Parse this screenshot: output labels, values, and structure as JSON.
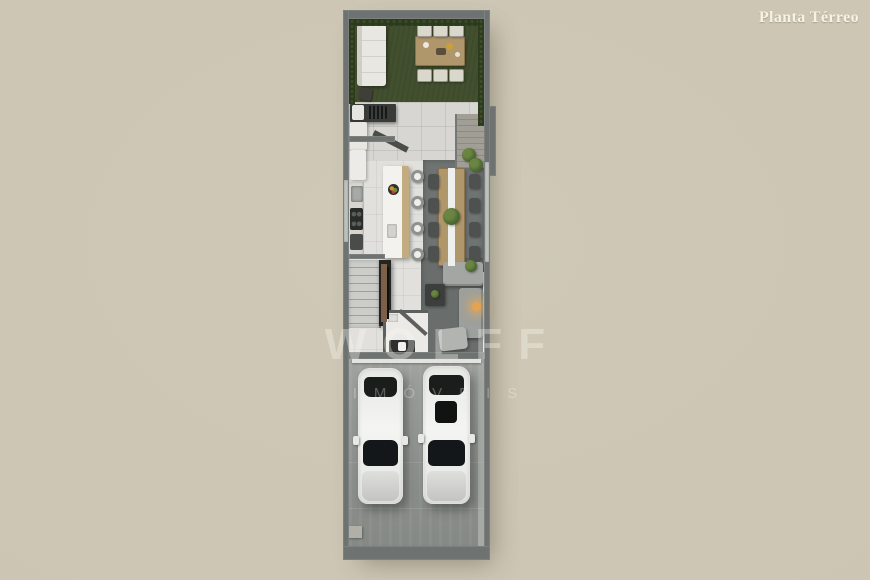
{
  "header": {
    "plan_label": "Planta Térreo"
  },
  "watermark": {
    "brand": "WOLFF",
    "tagline": "IMÓVEIS"
  },
  "colors": {
    "background": "#cfc8b6",
    "wall": "#6e7270",
    "grass": "#43502f",
    "hedge": "#2c3a1e",
    "patio_tile": "#d7d6d2",
    "interior_floor": "#e1e0dc",
    "wood": "#b0966b",
    "rug_dining": "#6f7473",
    "rug_living": "#696e6d",
    "sofa_gray": "#a3a6a3",
    "garage_floor": "#979a97",
    "car_body": "#ededeb",
    "car_glass": "#1a1d1b",
    "label_text": "#f6f2e5",
    "lamp_glow": "#e6a24e",
    "plant_green": "#4f6b33"
  }
}
